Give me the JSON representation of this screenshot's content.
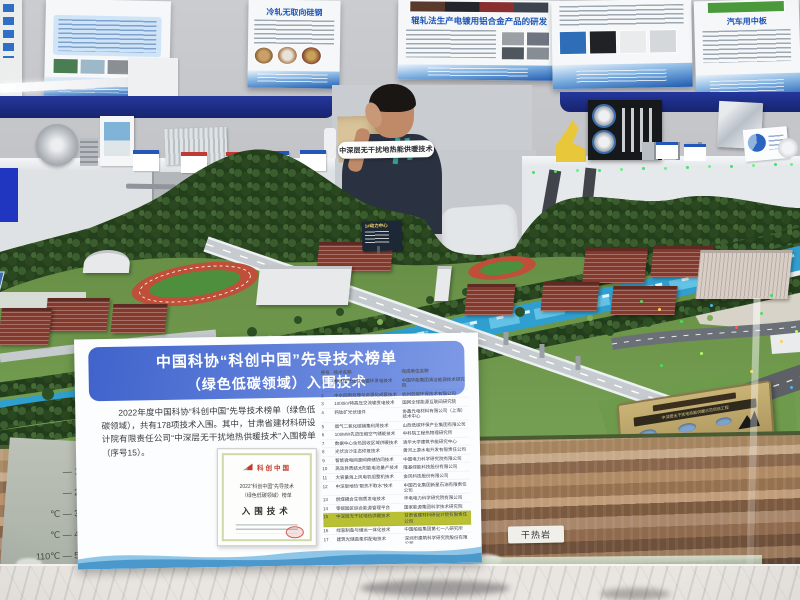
{
  "scene": {
    "description": "展馆展台实景：中深层无干扰地热能供暖技术沙盘模型"
  },
  "colors": {
    "header_blue": "#3f63cc",
    "highlight_yellow": "#b9c033",
    "navy_band": "#1d2f8f",
    "river_blue": "#2f9fd0",
    "plaque_gold": "#b9a468"
  },
  "wall_posters": {
    "poster_cold_rolled_title": "冷轧无取向硅钢",
    "poster_roll_plating_title": "辊轧法生产电镀用铝合金产品的研发",
    "poster_auto_plate_title": "汽车用中板"
  },
  "booth": {
    "model_sign": "中深层无干扰地热能供暖技术",
    "model_billboard_title": "1#动力中心",
    "rock_label": "干热岩",
    "plaque_banner": "中深层无干扰地热能供暖示范项目工程"
  },
  "depth_scale": {
    "labels": [
      "0m",
      "— 1000m",
      "— 2000m",
      "℃ — 3000m",
      "℃ — 4000m",
      "110℃ — 5000m"
    ]
  },
  "placard": {
    "title_line1": "中国科协“科创中国”先导技术榜单",
    "title_line2": "（绿色低碳领域）入围技术",
    "body": "2022年度中国科协“科创中国”先导技术榜单（绿色低碳领域），共有178项技术入围。其中，甘肃省建材科研设计院有限责任公司“中深层无干扰地热供暖技术”入围榜单（序号15）。",
    "certificate": {
      "brand": "科创中国",
      "line1": "2022“科创中国”先导技术",
      "line2": "（绿色低碳领域）榜单",
      "award": "入围技术"
    },
    "table": {
      "headers": [
        "序号",
        "技术名称",
        "完成单位名称"
      ],
      "highlight_row": 15,
      "rows": [
        [
          "1",
          "整体煤气化联合循环发电技术",
          "中国华能集团清洁能源技术研究院"
        ],
        [
          "2",
          "中水回用处理与资源化成套技术",
          "杭州低碳环保技术有限公司"
        ],
        [
          "3",
          "1000kV特高压交流输变电技术",
          "国网全球能源互联网研究院"
        ],
        [
          "4",
          "钙钛矿光伏组件",
          "协鑫光电材料有限公司（上海）技术中心"
        ],
        [
          "5",
          "烟气二氧化碳捕集利用技术",
          "山西低碳环保产业集团有限公司"
        ],
        [
          "6",
          "100MW先进压缩空气储能技术",
          "中科院工程热物理研究所"
        ],
        [
          "7",
          "数据中心余热回收区域供暖技术",
          "清华大学建筑节能研究中心"
        ],
        [
          "8",
          "光伏治沙生态修复技术",
          "黄河上游水电开发有限责任公司"
        ],
        [
          "9",
          "智能微电网源网荷储协同技术",
          "中国电力科学研究院有限公司"
        ],
        [
          "10",
          "高效异质结太阳能电池量产技术",
          "隆基绿能科技股份有限公司"
        ],
        [
          "11",
          "大容量海上风电机组整机技术",
          "金风科技股份有限公司"
        ],
        [
          "12",
          "中深层地热“取热不取水”技术",
          "中国石化集团新星石油有限责任公司"
        ],
        [
          "13",
          "燃煤耦合生物质发电技术",
          "华电电力科学研究院有限公司"
        ],
        [
          "14",
          "零碳园区综合能源管理平台",
          "国家能源集团科学技术研究院"
        ],
        [
          "15",
          "中深层无干扰地热供暖技术",
          "甘肃省建材科研设计院有限责任公司"
        ],
        [
          "16",
          "绿氢制备与储运一体化技术",
          "中国船舶集团第七一八研究所"
        ],
        [
          "17",
          "建筑光储直柔供配电技术",
          "深圳市建筑科学研究院股份有限公司"
        ],
        [
          "18",
          "高性能相变储热材料与装备",
          "北京热力先进技术研究有限公司"
        ]
      ]
    }
  }
}
